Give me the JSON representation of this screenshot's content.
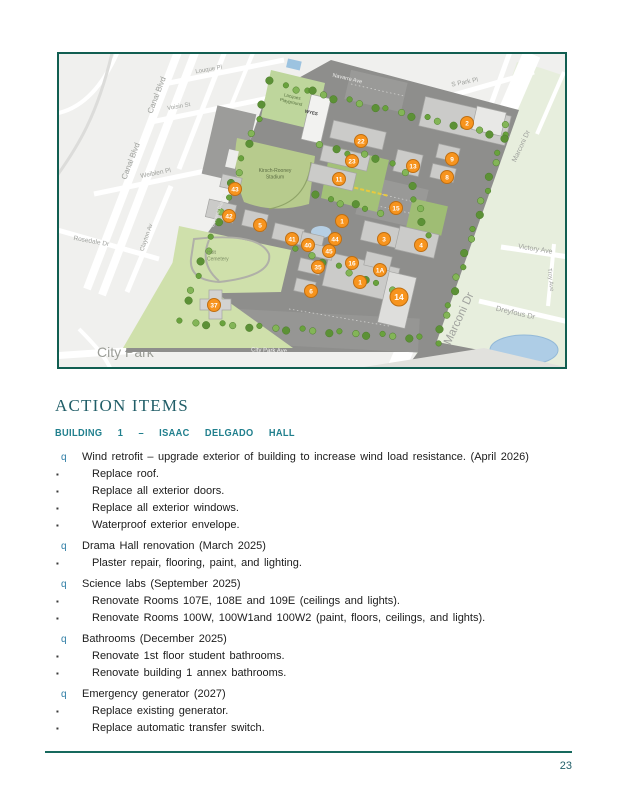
{
  "document": {
    "section_heading": "ACTION ITEMS",
    "building_heading": "BUILDING 1 – ISAAC DELGADO HALL",
    "page_number": "23",
    "colors": {
      "heading_teal": "#215e68",
      "subheading_teal": "#207f8d",
      "bullet_teal": "#2e7da5",
      "footer_rule_teal": "#17695d",
      "map_border_teal": "#115e51",
      "marker_orange": "#F7941E"
    }
  },
  "action_items": {
    "group_bullet_glyph": "q",
    "item_bullet_glyph": "▪",
    "groups": [
      {
        "title": "Wind retrofit – upgrade exterior of building to increase wind load resistance. (April 2026)",
        "items": [
          "Replace roof.",
          "Replace all exterior doors.",
          "Replace all exterior windows.",
          "Waterproof exterior envelope."
        ]
      },
      {
        "title": "Drama Hall renovation (March 2025)",
        "items": [
          "Plaster repair, flooring, paint, and lighting."
        ]
      },
      {
        "title": "Science labs (September 2025)",
        "items": [
          "Renovate Rooms 107E, 108E and 109E (ceilings and lights).",
          "Renovate Rooms 100W, 100W1and 100W2 (paint, floors, ceilings, and lights)."
        ]
      },
      {
        "title": "Bathrooms (December 2025)",
        "items": [
          "Renovate 1st floor student bathrooms.",
          "Renovate building 1 annex bathrooms."
        ]
      },
      {
        "title": "Emergency generator (2027)",
        "items": [
          "Replace existing generator.",
          "Replace automatic transfer switch."
        ]
      }
    ]
  },
  "map": {
    "markers": [
      {
        "n": "2",
        "x": 408,
        "y": 69
      },
      {
        "n": "22",
        "x": 302,
        "y": 87
      },
      {
        "n": "23",
        "x": 293,
        "y": 107
      },
      {
        "n": "11",
        "x": 280,
        "y": 125
      },
      {
        "n": "13",
        "x": 354,
        "y": 112
      },
      {
        "n": "9",
        "x": 393,
        "y": 105
      },
      {
        "n": "8",
        "x": 388,
        "y": 123
      },
      {
        "n": "15",
        "x": 337,
        "y": 154
      },
      {
        "n": "1",
        "x": 283,
        "y": 167
      },
      {
        "n": "43",
        "x": 176,
        "y": 135
      },
      {
        "n": "42",
        "x": 170,
        "y": 162
      },
      {
        "n": "5",
        "x": 201,
        "y": 171
      },
      {
        "n": "41",
        "x": 233,
        "y": 185
      },
      {
        "n": "40",
        "x": 249,
        "y": 191
      },
      {
        "n": "44",
        "x": 276,
        "y": 185
      },
      {
        "n": "45",
        "x": 270,
        "y": 197
      },
      {
        "n": "35",
        "x": 259,
        "y": 213
      },
      {
        "n": "3",
        "x": 325,
        "y": 185
      },
      {
        "n": "4",
        "x": 362,
        "y": 191
      },
      {
        "n": "16",
        "x": 293,
        "y": 209
      },
      {
        "n": "1A",
        "x": 321,
        "y": 216
      },
      {
        "n": "1",
        "x": 301,
        "y": 228
      },
      {
        "n": "6",
        "x": 252,
        "y": 237
      },
      {
        "n": "14",
        "x": 340,
        "y": 243,
        "big": true
      },
      {
        "n": "37",
        "x": 155,
        "y": 251
      }
    ],
    "labels": [
      {
        "text": "Canal Blvd",
        "x": 100,
        "y": 42,
        "rotate": -69,
        "size": 8
      },
      {
        "text": "Canal Blvd",
        "x": 74,
        "y": 108,
        "rotate": -69,
        "size": 8
      },
      {
        "text": "Louque Pl",
        "x": 150,
        "y": 17,
        "rotate": -10,
        "size": 6
      },
      {
        "text": "Voisin St",
        "x": 120,
        "y": 54,
        "rotate": -10,
        "size": 6
      },
      {
        "text": "Weiblen Pl",
        "x": 97,
        "y": 121,
        "rotate": -11,
        "size": 6.5
      },
      {
        "text": "Rosedale Dr",
        "x": 32,
        "y": 189,
        "rotate": 10,
        "size": 6.5
      },
      {
        "text": "Clayton Av",
        "x": 89,
        "y": 184,
        "rotate": -71,
        "size": 6
      },
      {
        "text": "City Park",
        "x": 38,
        "y": 303,
        "size": 14,
        "color": "#9b9d97",
        "anchor": "start",
        "layer": "under"
      },
      {
        "text": "City Park Ave",
        "x": 210,
        "y": 298,
        "rotate": 2,
        "size": 6,
        "color": "#f2f2f0"
      },
      {
        "text": "S Park Pl",
        "x": 406,
        "y": 30,
        "rotate": -11,
        "size": 6.5
      },
      {
        "text": "Marconi Dr",
        "x": 464,
        "y": 93,
        "rotate": -65,
        "size": 7
      },
      {
        "text": "Marconi Dr",
        "x": 403,
        "y": 266,
        "rotate": -65,
        "size": 11.5
      },
      {
        "text": "Victory Ave",
        "x": 476,
        "y": 197,
        "rotate": 9,
        "size": 7
      },
      {
        "text": "Troy Ave",
        "x": 490,
        "y": 226,
        "rotate": 84,
        "size": 6
      },
      {
        "text": "Dreyfous Dr",
        "x": 456,
        "y": 261,
        "rotate": 13,
        "size": 7.5
      },
      {
        "text": "Navarre Ave",
        "x": 288,
        "y": 26,
        "rotate": 13,
        "size": 5.5,
        "color": "#ededeb"
      },
      {
        "text": "General Diaz St",
        "x": 161,
        "y": 157,
        "rotate": -69,
        "size": 5,
        "color": "#e6e6e4"
      },
      {
        "text": "WYES",
        "x": 252,
        "y": 60,
        "rotate": 13,
        "size": 4.5,
        "color": "#3f3f3f",
        "weight": "bold"
      },
      {
        "lines": [
          "Kirsch-Rooney",
          "Stadium"
        ],
        "x": 216,
        "y": 118,
        "size": 5,
        "color": "#5d6e44"
      },
      {
        "lines": [
          "Holt",
          "Cemetery"
        ],
        "x": 148,
        "y": 200,
        "size": 5,
        "color": "#7c8c64",
        "anchor": "start"
      },
      {
        "lines": [
          "Lacques",
          "Playground"
        ],
        "x": 233,
        "y": 44,
        "rotate": 13,
        "size": 4.5,
        "color": "#56703e"
      }
    ]
  }
}
